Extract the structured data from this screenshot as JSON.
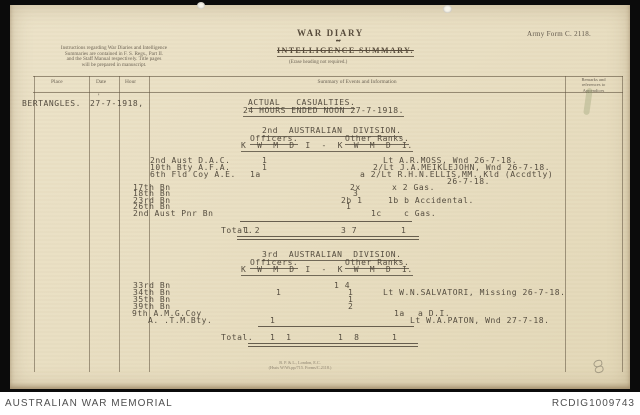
{
  "footer": {
    "left": "AUSTRALIAN WAR MEMORIAL",
    "right": "RCDIG1009743"
  },
  "form": {
    "army_form_no": "Army Form C. 2118.",
    "title": "WAR DIARY",
    "conjunction": "or",
    "subtitle": "INTELLIGENCE SUMMARY.",
    "subtitle_note": "(Erase heading not required.)",
    "instructions": [
      "Instructions regarding War Diaries and Intelligence",
      "Summaries are contained in F. S. Regs., Part II.",
      "and the Staff Manual respectively.  Title pages",
      "will be prepared in manuscript."
    ],
    "col_place": "Place",
    "col_date": "Date",
    "col_hour": "Hour",
    "col_summary": "Summary of Events and Information",
    "col_remarks": [
      "Remarks and",
      "references to",
      "Appendices"
    ],
    "printer": [
      "B. P. & L., London, E.C.",
      "(Hssts W/Wt.pp/715.  Forms/C.2118.)"
    ]
  },
  "entry": {
    "place": "BERTANGLES.",
    "date": "27-7-1918,",
    "tick": "'"
  },
  "typed_lines": [
    {
      "x": 248,
      "y": 99,
      "t": "ACTUAL   CASUALTIES.",
      "u": true
    },
    {
      "x": 243,
      "y": 107,
      "t": "24 HOURS ENDED NOON 27-7-1918.",
      "u": true
    },
    {
      "x": 262,
      "y": 127,
      "t": "2nd  AUSTRALIAN  DIVISION.",
      "u": true
    },
    {
      "x": 250,
      "y": 135,
      "t": "Officers.",
      "u": true
    },
    {
      "x": 345,
      "y": 135,
      "t": "Other Ranks.",
      "u": true
    },
    {
      "x": 241,
      "y": 142,
      "t": "K  W  M  D  I  -  K  W  M  D  I.",
      "u": true
    },
    {
      "x": 150,
      "y": 157,
      "t": "2nd Aust D.A.C."
    },
    {
      "x": 262,
      "y": 157,
      "t": "1"
    },
    {
      "x": 383,
      "y": 157,
      "t": "Lt A.R.MOSS, Wnd 26-7-18."
    },
    {
      "x": 150,
      "y": 164,
      "t": "10th Bty A.F.A."
    },
    {
      "x": 262,
      "y": 164,
      "t": "1"
    },
    {
      "x": 373,
      "y": 164,
      "t": "2/Lt J.A.MEIKLEJOHN, Wnd 26-7-18."
    },
    {
      "x": 150,
      "y": 171,
      "t": "6th Fld Coy A.E."
    },
    {
      "x": 250,
      "y": 171,
      "t": "1a"
    },
    {
      "x": 360,
      "y": 171,
      "t": "a 2/Lt R.H.N.ELLIS,MM.,Kld (Accdtly)"
    },
    {
      "x": 447,
      "y": 178,
      "t": "26-7-18."
    },
    {
      "x": 133,
      "y": 184,
      "t": "17th Bn"
    },
    {
      "x": 350,
      "y": 184,
      "t": "2x"
    },
    {
      "x": 392,
      "y": 184,
      "t": "x 2 Gas."
    },
    {
      "x": 133,
      "y": 190,
      "t": "18th Bn"
    },
    {
      "x": 353,
      "y": 190,
      "t": "3"
    },
    {
      "x": 133,
      "y": 197,
      "t": "23rd Bn"
    },
    {
      "x": 341,
      "y": 197,
      "t": "2b 1"
    },
    {
      "x": 388,
      "y": 197,
      "t": "1b b Accidental."
    },
    {
      "x": 133,
      "y": 203,
      "t": "26th Bn"
    },
    {
      "x": 346,
      "y": 203,
      "t": "1"
    },
    {
      "x": 133,
      "y": 210,
      "t": "2nd Aust Pnr Bn"
    },
    {
      "x": 371,
      "y": 210,
      "t": "1c"
    },
    {
      "x": 404,
      "y": 210,
      "t": "c Gas."
    },
    {
      "x": 221,
      "y": 227,
      "t": "Total."
    },
    {
      "x": 244,
      "y": 227,
      "t": "1 2"
    },
    {
      "x": 341,
      "y": 227,
      "t": "3 7"
    },
    {
      "x": 401,
      "y": 227,
      "t": "1"
    },
    {
      "x": 262,
      "y": 251,
      "t": "3rd  AUSTRALIAN  DIVISION.",
      "u": true
    },
    {
      "x": 250,
      "y": 259,
      "t": "Officers.",
      "u": true
    },
    {
      "x": 345,
      "y": 259,
      "t": "Other Ranks.",
      "u": true
    },
    {
      "x": 241,
      "y": 266,
      "t": "K  W  M  D  I  -  K  W  M  D  I.",
      "u": true
    },
    {
      "x": 133,
      "y": 282,
      "t": "33rd Bn"
    },
    {
      "x": 334,
      "y": 282,
      "t": "1 4"
    },
    {
      "x": 133,
      "y": 289,
      "t": "34th Bn"
    },
    {
      "x": 276,
      "y": 289,
      "t": "1"
    },
    {
      "x": 348,
      "y": 289,
      "t": "1"
    },
    {
      "x": 383,
      "y": 289,
      "t": "Lt W.N.SALVATORI, Missing 26-7-18."
    },
    {
      "x": 133,
      "y": 296,
      "t": "35th Bn"
    },
    {
      "x": 348,
      "y": 296,
      "t": "1"
    },
    {
      "x": 133,
      "y": 303,
      "t": "39th Bn"
    },
    {
      "x": 348,
      "y": 303,
      "t": "2"
    },
    {
      "x": 132,
      "y": 310,
      "t": "9th A.M.G.Coy"
    },
    {
      "x": 394,
      "y": 310,
      "t": "1a"
    },
    {
      "x": 418,
      "y": 310,
      "t": "a D.I."
    },
    {
      "x": 148,
      "y": 317,
      "t": "A. .T.M.Bty."
    },
    {
      "x": 270,
      "y": 317,
      "t": "1"
    },
    {
      "x": 410,
      "y": 317,
      "t": "Lt W.A.PATON, Wnd 27-7-18."
    },
    {
      "x": 221,
      "y": 334,
      "t": "Total."
    },
    {
      "x": 270,
      "y": 334,
      "t": "1  1"
    },
    {
      "x": 338,
      "y": 334,
      "t": "1  8"
    },
    {
      "x": 392,
      "y": 334,
      "t": "1"
    }
  ],
  "rules": [
    {
      "x": 240,
      "y": 221,
      "w": 172
    },
    {
      "x": 237,
      "y": 236,
      "w": 182,
      "d": true
    },
    {
      "x": 258,
      "y": 326,
      "w": 156
    },
    {
      "x": 248,
      "y": 343,
      "w": 170,
      "d": true
    }
  ]
}
